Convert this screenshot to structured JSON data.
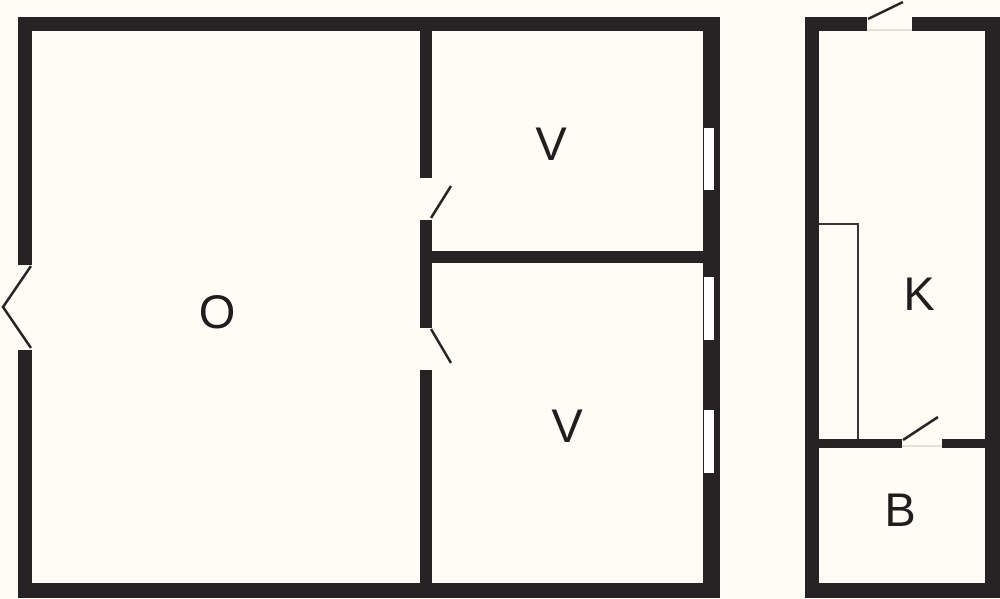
{
  "plan": {
    "type": "floor-plan",
    "colors": {
      "wall": "#272324",
      "background": "#fdfdf6",
      "window": "#ffffff",
      "thin_line": "#3a3637",
      "label": "#1f1d1e",
      "threshold": "#e2e2da"
    },
    "main_building": {
      "rooms": [
        {
          "id": "living-room",
          "label": "O"
        },
        {
          "id": "bedroom-upper",
          "label": "V"
        },
        {
          "id": "bedroom-lower",
          "label": "V"
        }
      ],
      "features": [
        "double-exterior-door-left",
        "two-interior-doors",
        "three-windows-right-wall"
      ]
    },
    "annex_building": {
      "rooms": [
        {
          "id": "kitchen",
          "label": "K"
        },
        {
          "id": "bathroom",
          "label": "B"
        }
      ],
      "features": [
        "exterior-door-top",
        "interior-door-bathroom",
        "counter-outline"
      ]
    }
  }
}
